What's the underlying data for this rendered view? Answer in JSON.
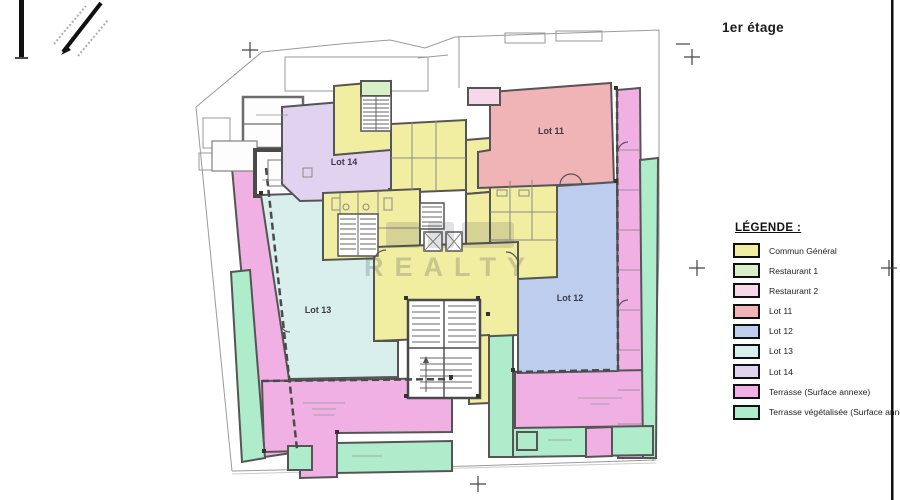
{
  "page": {
    "title": "1er étage",
    "watermark": "REALTY"
  },
  "legend": {
    "title": "LÉGENDE :",
    "items": [
      {
        "label": "Commun Général",
        "color": "#f1eda1"
      },
      {
        "label": "Restaurant 1",
        "color": "#d8f0c9"
      },
      {
        "label": "Restaurant 2",
        "color": "#f7d8e8"
      },
      {
        "label": "Lot 11",
        "color": "#f1b4b6"
      },
      {
        "label": "Lot 12",
        "color": "#bccdee"
      },
      {
        "label": "Lot 13",
        "color": "#d9efec"
      },
      {
        "label": "Lot 14",
        "color": "#e1d2ef"
      },
      {
        "label": "Terrasse (Surface annexe)",
        "color": "#f0b0e4"
      },
      {
        "label": "Terrasse végétalisée (Surface annexe)",
        "color": "#aeeccc"
      }
    ]
  },
  "plan": {
    "labels": {
      "lot11": "Lot 11",
      "lot12": "Lot 12",
      "lot13": "Lot 13",
      "lot14": "Lot 14"
    }
  }
}
